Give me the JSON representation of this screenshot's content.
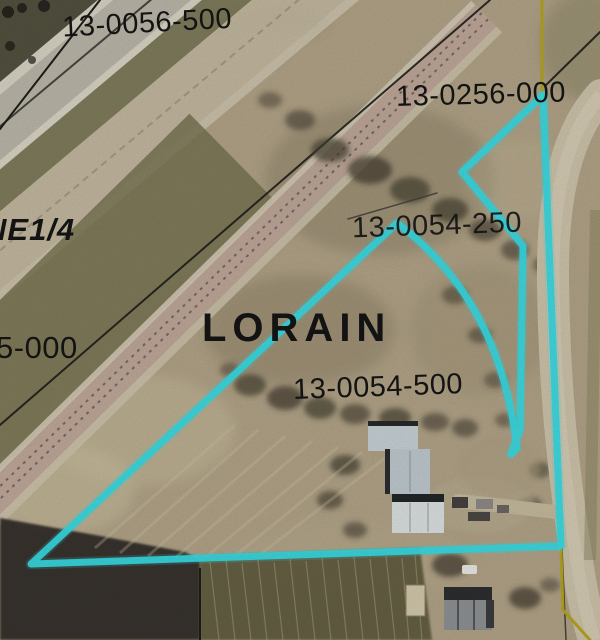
{
  "map": {
    "labels": {
      "parcel_top_left": "13-0056-500",
      "parcel_top_right": "13-0256-000",
      "parcel_mid_right": "13-0054-250",
      "parcel_center": "13-0054-500",
      "parcel_left_partial": "5-000",
      "township": "LORAIN",
      "quarter_section": "NE1/4"
    },
    "highlighted_parcel": "13-0054-500",
    "feature_names": {
      "highlight_outline": "selected-parcel-boundary",
      "yellow_line": "section-line",
      "black_lines": "lot-lines",
      "corridor": "highway-and-railroad-corridor"
    }
  },
  "colors": {
    "parcel_highlight": "#39dbe4",
    "section_line": "#b4a51d",
    "lot_line": "#1d1d1a",
    "label_text": "#151515"
  }
}
